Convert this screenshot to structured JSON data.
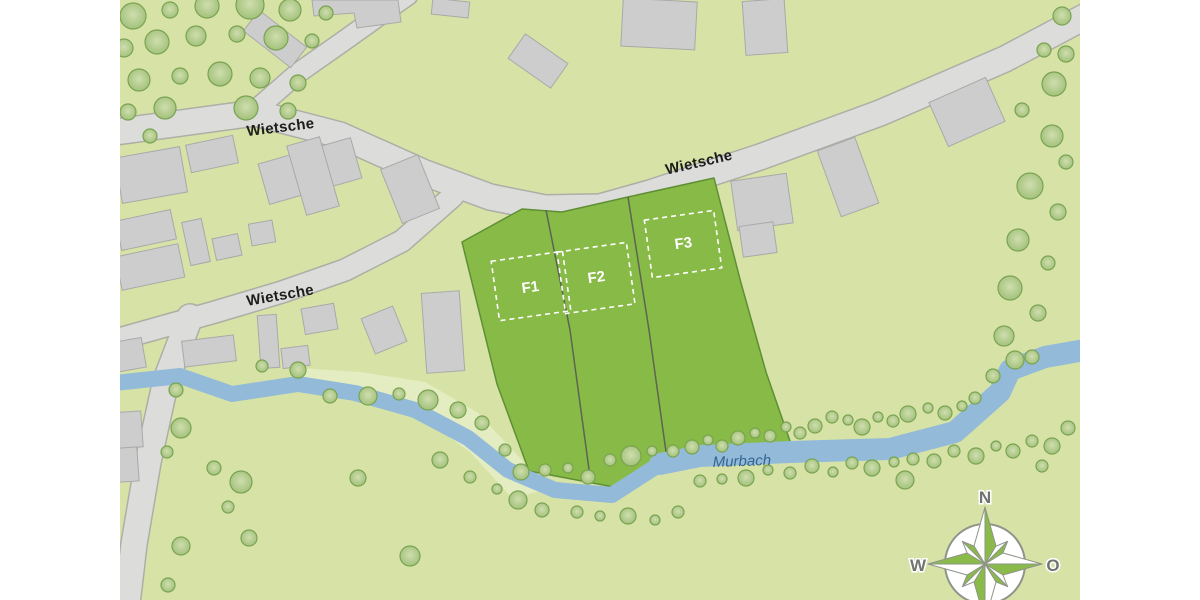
{
  "map": {
    "road_name": "Wietsche",
    "stream_name": "Murbach",
    "plots": [
      {
        "id": "F1",
        "label": "F1"
      },
      {
        "id": "F2",
        "label": "F2"
      },
      {
        "id": "F3",
        "label": "F3"
      }
    ],
    "compass": {
      "north": "N",
      "east": "O",
      "west": "W"
    },
    "trees": [
      [
        133,
        16,
        13
      ],
      [
        170,
        10,
        8
      ],
      [
        207,
        6,
        12
      ],
      [
        250,
        5,
        14
      ],
      [
        290,
        10,
        11
      ],
      [
        326,
        13,
        7
      ],
      [
        124,
        48,
        9
      ],
      [
        157,
        42,
        12
      ],
      [
        196,
        36,
        10
      ],
      [
        237,
        34,
        8
      ],
      [
        276,
        38,
        12
      ],
      [
        312,
        41,
        7
      ],
      [
        139,
        80,
        11
      ],
      [
        180,
        76,
        8
      ],
      [
        220,
        74,
        12
      ],
      [
        260,
        78,
        10
      ],
      [
        298,
        83,
        8
      ],
      [
        128,
        112,
        8
      ],
      [
        165,
        108,
        11
      ],
      [
        246,
        108,
        12
      ],
      [
        288,
        111,
        8
      ],
      [
        150,
        136,
        7
      ],
      [
        1062,
        16,
        9
      ],
      [
        1044,
        50,
        7
      ],
      [
        1066,
        54,
        8
      ],
      [
        1054,
        84,
        12
      ],
      [
        1022,
        110,
        7
      ],
      [
        1052,
        136,
        11
      ],
      [
        1066,
        162,
        7
      ],
      [
        1030,
        186,
        13
      ],
      [
        1058,
        212,
        8
      ],
      [
        1018,
        240,
        11
      ],
      [
        1048,
        263,
        7
      ],
      [
        1010,
        288,
        12
      ],
      [
        1038,
        313,
        8
      ],
      [
        1004,
        336,
        10
      ],
      [
        1032,
        357,
        7
      ],
      [
        176,
        390,
        7
      ],
      [
        181,
        428,
        10
      ],
      [
        167,
        452,
        6
      ],
      [
        214,
        468,
        7
      ],
      [
        241,
        482,
        11
      ],
      [
        228,
        507,
        6
      ],
      [
        249,
        538,
        8
      ],
      [
        181,
        546,
        9
      ],
      [
        168,
        585,
        7
      ],
      [
        262,
        366,
        6
      ],
      [
        298,
        370,
        8
      ],
      [
        330,
        396,
        7
      ],
      [
        368,
        396,
        9
      ],
      [
        399,
        394,
        6
      ],
      [
        358,
        478,
        8
      ],
      [
        410,
        556,
        10
      ],
      [
        428,
        400,
        10
      ],
      [
        458,
        410,
        8
      ],
      [
        482,
        423,
        7
      ],
      [
        505,
        450,
        6
      ],
      [
        521,
        472,
        8
      ],
      [
        545,
        470,
        6
      ],
      [
        568,
        468,
        5
      ],
      [
        588,
        477,
        7
      ],
      [
        610,
        460,
        6
      ],
      [
        631,
        456,
        10
      ],
      [
        652,
        451,
        5
      ],
      [
        673,
        451,
        6
      ],
      [
        692,
        447,
        7
      ],
      [
        708,
        440,
        5
      ],
      [
        722,
        446,
        6
      ],
      [
        738,
        438,
        7
      ],
      [
        755,
        433,
        5
      ],
      [
        770,
        436,
        6
      ],
      [
        786,
        427,
        5
      ],
      [
        800,
        433,
        6
      ],
      [
        815,
        426,
        7
      ],
      [
        832,
        417,
        6
      ],
      [
        848,
        420,
        5
      ],
      [
        862,
        427,
        8
      ],
      [
        878,
        417,
        5
      ],
      [
        893,
        421,
        6
      ],
      [
        908,
        414,
        8
      ],
      [
        928,
        408,
        5
      ],
      [
        945,
        413,
        7
      ],
      [
        962,
        406,
        5
      ],
      [
        975,
        398,
        6
      ],
      [
        993,
        376,
        7
      ],
      [
        1015,
        360,
        9
      ],
      [
        440,
        460,
        8
      ],
      [
        470,
        477,
        6
      ],
      [
        497,
        489,
        5
      ],
      [
        518,
        500,
        9
      ],
      [
        542,
        510,
        7
      ],
      [
        577,
        512,
        6
      ],
      [
        600,
        516,
        5
      ],
      [
        628,
        516,
        8
      ],
      [
        655,
        520,
        5
      ],
      [
        678,
        512,
        6
      ],
      [
        700,
        481,
        6
      ],
      [
        722,
        479,
        5
      ],
      [
        746,
        478,
        8
      ],
      [
        768,
        470,
        5
      ],
      [
        790,
        473,
        6
      ],
      [
        812,
        466,
        7
      ],
      [
        833,
        472,
        5
      ],
      [
        852,
        463,
        6
      ],
      [
        872,
        468,
        8
      ],
      [
        894,
        462,
        5
      ],
      [
        913,
        459,
        6
      ],
      [
        934,
        461,
        7
      ],
      [
        954,
        451,
        6
      ],
      [
        976,
        456,
        8
      ],
      [
        996,
        446,
        5
      ],
      [
        1013,
        451,
        7
      ],
      [
        1032,
        441,
        6
      ],
      [
        1052,
        446,
        8
      ],
      [
        1042,
        466,
        6
      ],
      [
        1068,
        428,
        7
      ],
      [
        905,
        480,
        9
      ]
    ]
  },
  "colors": {
    "canvas_bg": "#ffffff",
    "map_bg": "#d7e3a6",
    "meadow_light": "#e4edc2",
    "road_fill": "#dcdcdb",
    "road_edge": "#aeaea6",
    "building_fill": "#cdcdcd",
    "building_edge": "#a9a9a9",
    "plot_fill": "#88ba47",
    "plot_edge": "#5f8f35",
    "divider": "#5b6552",
    "stream_fill": "#93bad9",
    "stream_label": "#33658f",
    "tree_fill": "#9fbf77",
    "tree_core": "#cfdeae",
    "tree_edge": "#79a351",
    "road_label": "#1d1d1b",
    "plot_label": "#ffffff",
    "compass_green": "#8aba4a",
    "compass_edge": "#8e9489",
    "compass_letter": "#6f7471"
  }
}
